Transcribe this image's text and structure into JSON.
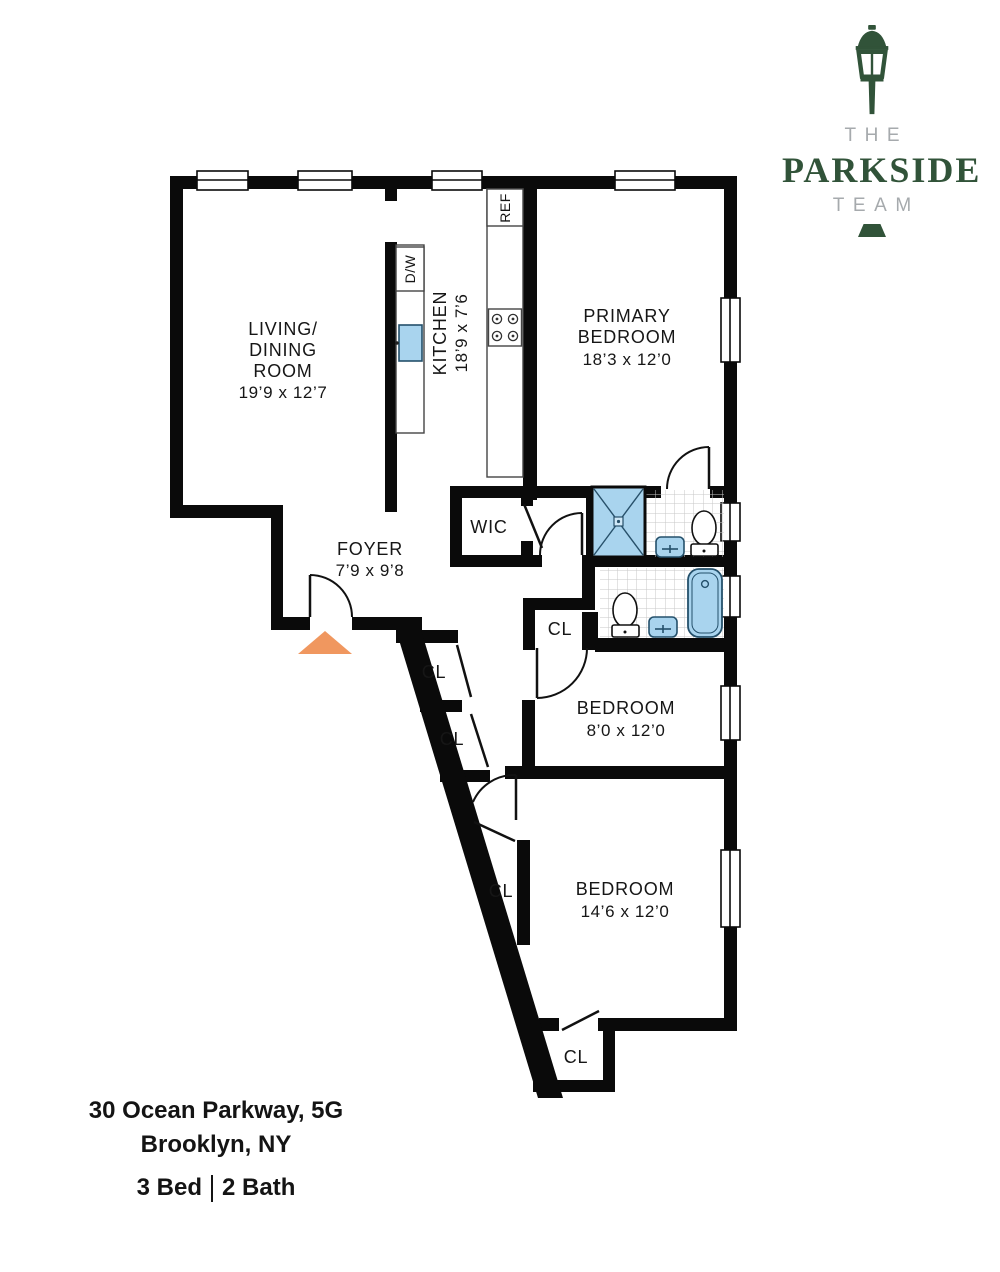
{
  "logo": {
    "brand_top": "THE",
    "brand_main": "PARKSIDE",
    "brand_bottom": "TEAM"
  },
  "footer": {
    "address_line1": "30 Ocean Parkway, 5G",
    "address_line2": "Brooklyn, NY",
    "beds": "3 Bed",
    "baths": "2 Bath"
  },
  "rooms": {
    "living": {
      "lines": [
        "LIVING/",
        "DINING",
        "ROOM"
      ],
      "dims": "19’9 x 12’7"
    },
    "kitchen": {
      "name": "KITCHEN",
      "dims": "18’9 x 7’6"
    },
    "primary": {
      "lines": [
        "PRIMARY",
        "BEDROOM"
      ],
      "dims": "18’3 x 12’0"
    },
    "foyer": {
      "name": "FOYER",
      "dims": "7’9 x 9’8"
    },
    "wic": {
      "name": "WIC"
    },
    "bedroom_mid": {
      "name": "BEDROOM",
      "dims": "8’0 x 12’0"
    },
    "bedroom_bottom": {
      "name": "BEDROOM",
      "dims": "14’6 x 12’0"
    }
  },
  "closets": {
    "labels": [
      "CL",
      "CL",
      "CL",
      "CL",
      "CL"
    ]
  },
  "appliances": {
    "ref": "REF",
    "dishwasher": "D/W"
  },
  "colors": {
    "wall": "#0a0a0a",
    "fixture_blue": "#a9d4ee",
    "fixture_outline": "#24506b",
    "entry_arrow": "#f0975f",
    "logo_green": "#315339",
    "logo_gray": "#a6aaad",
    "tile_line": "#c7c7c7"
  }
}
